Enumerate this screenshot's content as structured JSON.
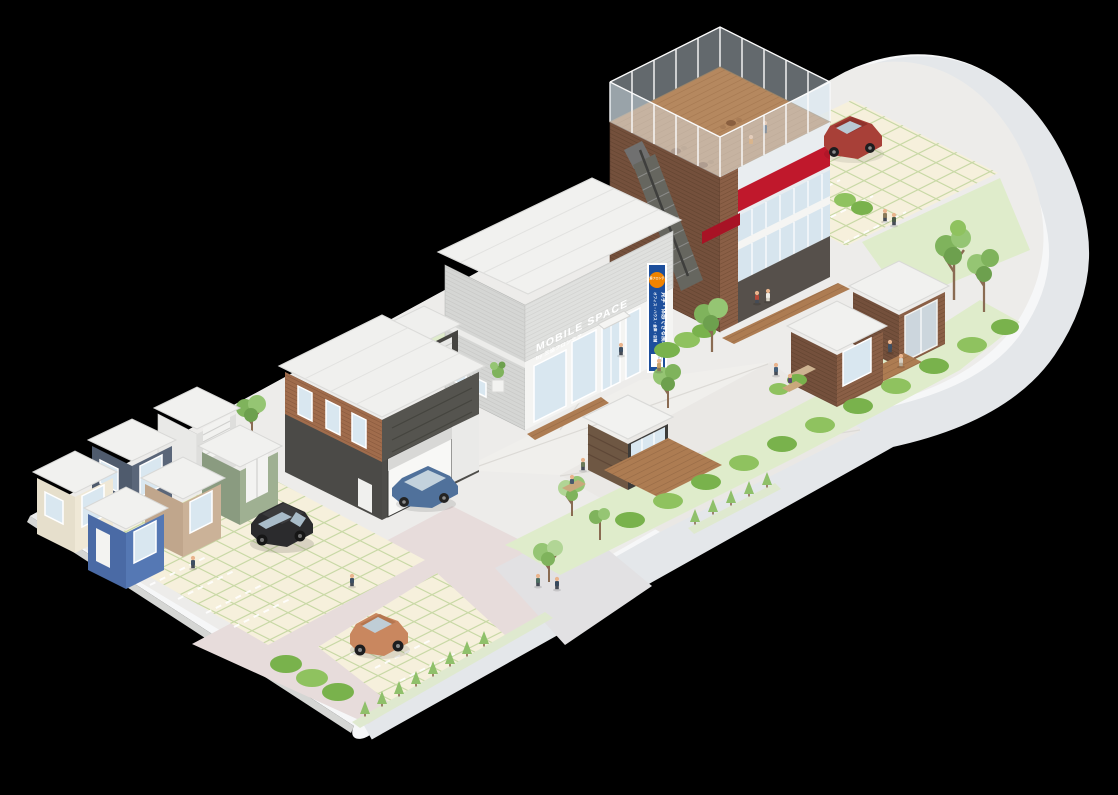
{
  "signage": {
    "building_sign": {
      "line1": "MOBILE SPACE",
      "line2": "by 三協フロンテア"
    },
    "vertical_banner": {
      "badge": "三協フロンテア",
      "main_text": "見学・体感できる展示場",
      "sub_text": "オフィス・ハウス・倉庫・店舗",
      "footer": "三協フロンテア"
    }
  },
  "colors": {
    "background": "#000000",
    "curb": "#f6f7f8",
    "road": "#e4e7ea",
    "ground": "#edecea",
    "pavement_pink": "#e7dcdb",
    "path_gray": "#e2e1e3",
    "lawn": "#dfeccb",
    "tile_cream": "#f6f0dc",
    "tile_grid_green": "#c9d9a6",
    "hedge_green": "#79b24c",
    "tree_green": "#7fb35c",
    "banner_blue": "#1d4f9c",
    "badge_orange": "#f08300",
    "accent_red": "#c0182c",
    "terrace_wood": "#b5885f",
    "wood_brown": "#8a5f46",
    "dark_wall": "#4b4a47",
    "container_cream": "#e6dfcc",
    "container_navy": "#4f5b6d",
    "container_blue": "#4a6aa5",
    "container_tan": "#c0a68c",
    "container_green": "#8a9b80",
    "car_black": "#2b2b2d",
    "car_red": "#a84038",
    "car_orange": "#c9875f",
    "car_blue": "#50719b"
  },
  "inventory": {
    "large_buildings": 3,
    "small_container_units": 6,
    "garden_cabins": 3,
    "storage_sheds": 2,
    "cars": 4,
    "people": 18,
    "rooftop_table_sets": 3
  }
}
